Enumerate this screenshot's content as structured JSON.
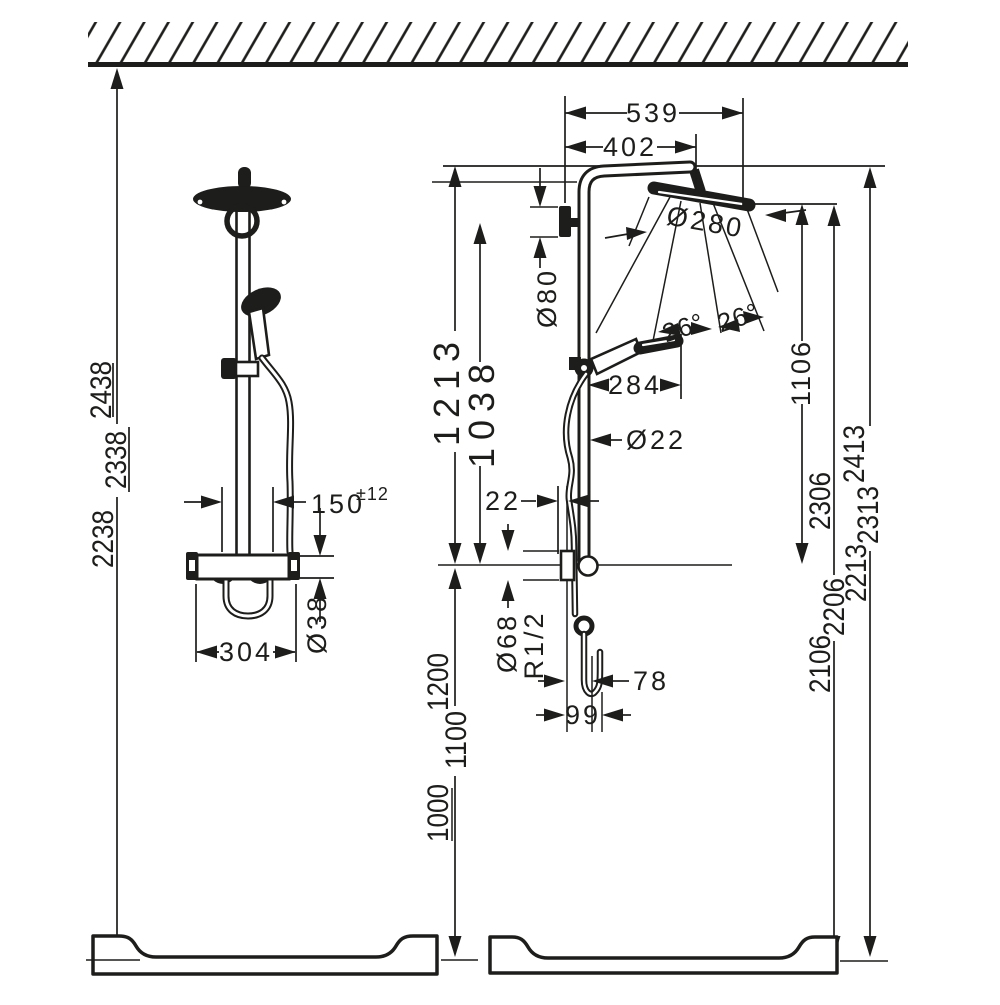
{
  "dims": {
    "d539": "539",
    "d402": "402",
    "d280": "Ø280",
    "d80": "Ø80",
    "d1213": "1213",
    "d1038": "1038",
    "angle1": "26°",
    "angle2": "26°",
    "d284": "284",
    "d22pipe": "Ø22",
    "d22": "22",
    "d68": "Ø68",
    "thread": "R1/2",
    "d78": "78",
    "d99": "99",
    "d1106": "1106",
    "d150": "150",
    "d150tol": "±12",
    "d38": "Ø38",
    "d304": "304",
    "left_heights": [
      "2438",
      "2338",
      "2238"
    ],
    "spray_heights": [
      "2306",
      "2206",
      "2106"
    ],
    "max_heights": [
      "2413",
      "2313",
      "2213"
    ],
    "floor_heights": [
      "1200",
      "1100",
      "1000"
    ]
  }
}
